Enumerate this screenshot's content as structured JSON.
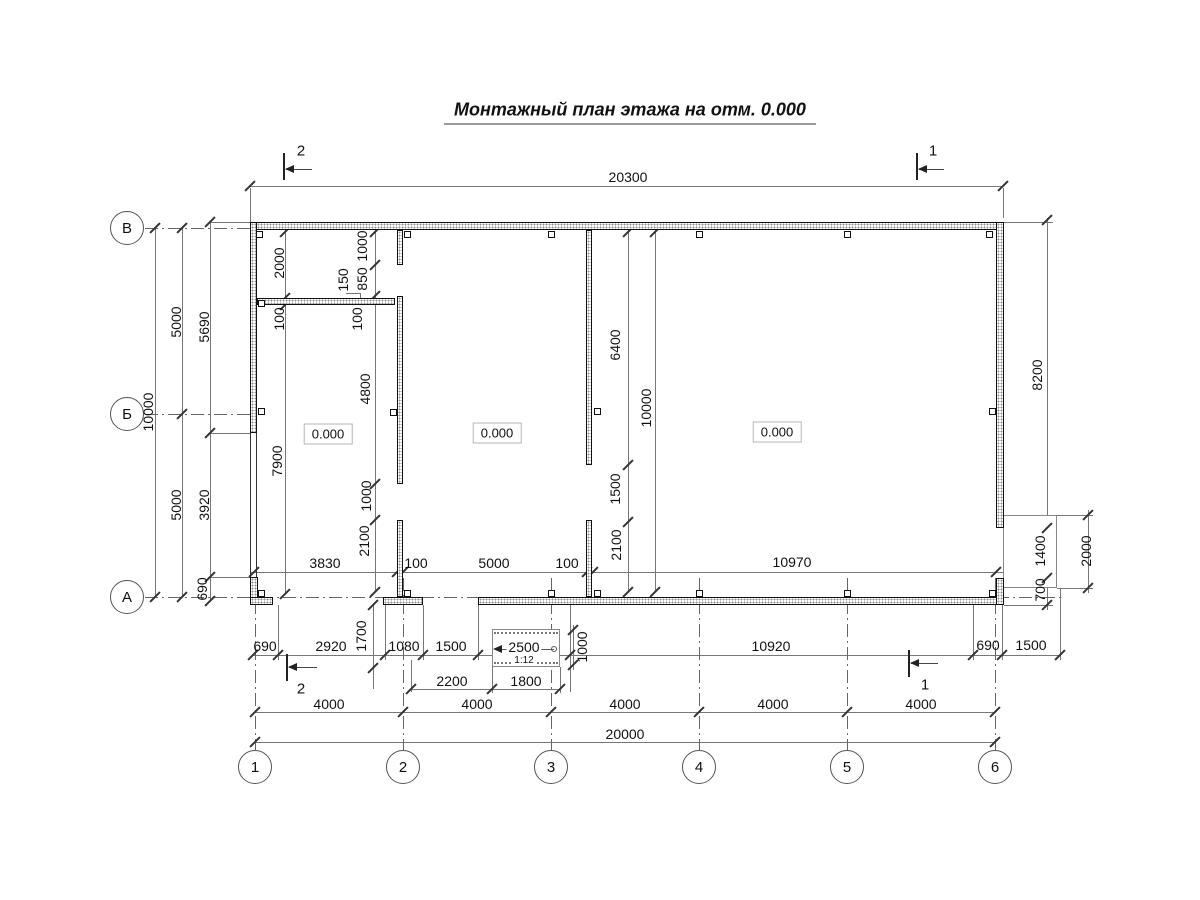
{
  "title": "Монтажный план этажа на отм. 0.000",
  "axes": {
    "horizontal": [
      "В",
      "Б",
      "А"
    ],
    "vertical": [
      "1",
      "2",
      "3",
      "4",
      "5",
      "6"
    ]
  },
  "sections": {
    "top_left": "2",
    "top_right": "1",
    "bottom_left": "2",
    "bottom_right": "1"
  },
  "elevations": {
    "room1": "0.000",
    "room2": "0.000",
    "room3": "0.000"
  },
  "ramp": {
    "length": "2500",
    "slope": "1:12"
  },
  "dims": {
    "overall_top": "20300",
    "left_overall": "10000",
    "left_span_top": "5000",
    "left_span_bottom": "5000",
    "left_wall_top": "5690",
    "left_window": "3920",
    "left_wall_bottom": "690",
    "room1_depth": "2000",
    "partition_thk": "100",
    "room1_height": "7900",
    "w1_stub": "1000",
    "w1_door": "850",
    "w1_offset": "150",
    "w1_thk_v": "100",
    "w1_mid": "4800",
    "w1_opening": "1000",
    "w1_lower": "2100",
    "w2_upper": "6400",
    "w2_opening": "1500",
    "w2_lower": "2100",
    "interior_height": "10000",
    "bay1": "3830",
    "w1_thk": "100",
    "bay2": "5000",
    "w2_thk": "100",
    "bay3": "10970",
    "right_wall": "8200",
    "right_door": "1400",
    "right_pier": "700",
    "porch_height": "2000",
    "b_690_left": "690",
    "b_2920": "2920",
    "b_1700": "1700",
    "b_1080": "1080",
    "b_1500": "1500",
    "b_1000": "1000",
    "b_10920": "10920",
    "b_690_right": "690",
    "b_1500_right": "1500",
    "porch_w1": "2200",
    "porch_w2": "1800",
    "grid_spans": [
      "4000",
      "4000",
      "4000",
      "4000",
      "4000"
    ],
    "grid_total": "20000"
  }
}
